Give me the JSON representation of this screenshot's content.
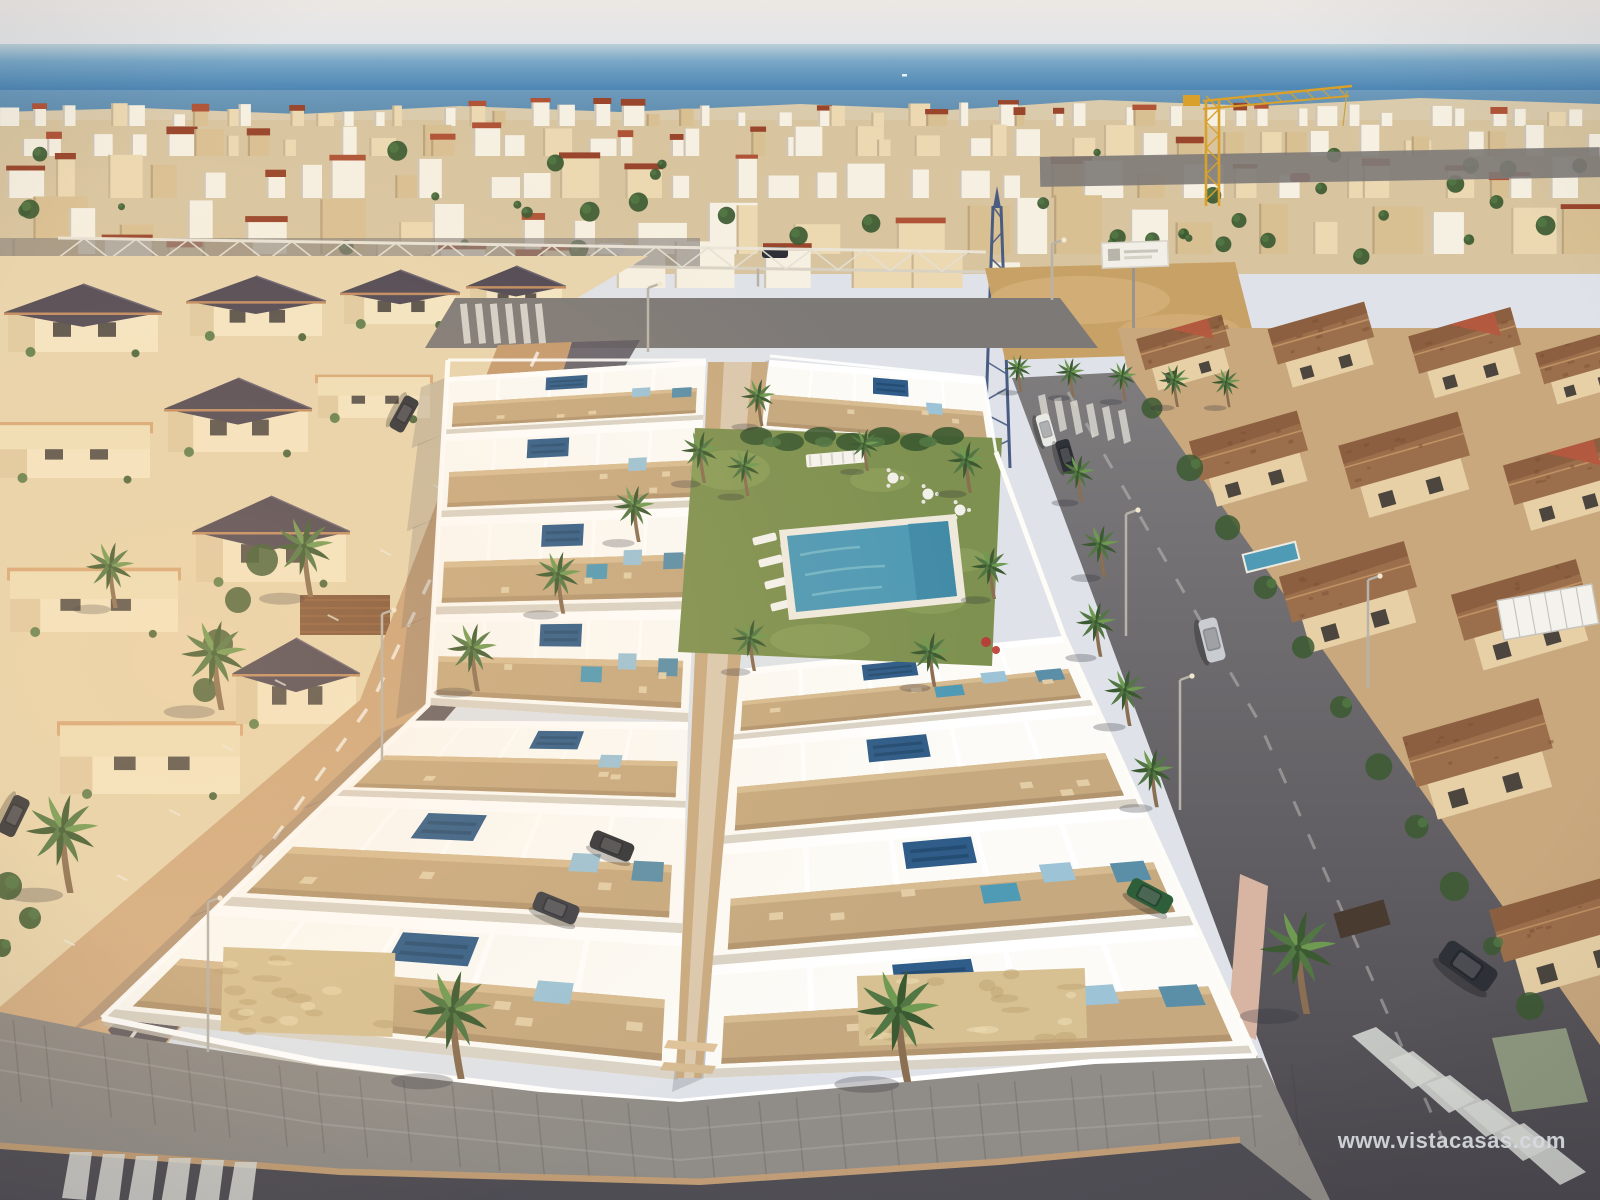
{
  "watermark": {
    "text": "www.vistacasas.com"
  },
  "palette": {
    "sky_top": "#ece8e4",
    "sky_horizon": "#e0e4e9",
    "sea_haze": "#bccfd8",
    "sea_light": "#78a6c6",
    "sea_mid": "#4a84b2",
    "sea_deep": "#38739f",
    "city_base": "#d8c5a0",
    "city_white": "#f6f0e2",
    "city_cream": "#ecd9b2",
    "city_tan": "#d9c093",
    "roof_red": "#b05438",
    "roof_red_dark": "#99462c",
    "roof_dark": "#4e4754",
    "palm_dark": "#3c5a31",
    "palm_mid": "#527744",
    "palm_light": "#6f9a52",
    "palm_trunk": "#8a6f52",
    "street_sun": "#c49a6e",
    "street_sun_deep": "#d7b288",
    "street_shadow": "#5e5a62",
    "rstreet_top": "#7e7c7d",
    "rstreet_bottom": "#4b494f",
    "asphalt": "#504e55",
    "sidewalk": "#908c87",
    "curb": "#c59f74",
    "dev_white": "#fcfbf7",
    "dev_off": "#e9e2d4",
    "dev_shadow": "#d9d3c7",
    "dev_shadow2": "#c7c0b4",
    "terrace": "#c6a97f",
    "terrace_light": "#d7bc92",
    "terrace_dark": "#b2956f",
    "solar": "#2f5c88",
    "solar_dark": "#234a6e",
    "accent_blue": "#9cc3d6",
    "accent_teal": "#5b8fa8",
    "pool": "#4f9ab5",
    "pool_light": "#85c2cd",
    "pool_dark": "#3f88a5",
    "pool_rim": "#efe9dc",
    "lawn": "#7e9150",
    "lawn_light": "#95a861",
    "sand": "#c8a166",
    "sand_light": "#d9b67f",
    "stone": "#d7c193",
    "stone_dark": "#bba06f",
    "terra_roof": "#9c6f4c",
    "terra_roof_dark": "#855a3b",
    "terra_wall": "#e7d0a6",
    "terra_red": "#b5593f",
    "crane_yellow": "#d9a02b",
    "crane_blue": "#4a5c82",
    "car_dark": "#2e3138",
    "car_silver": "#c9ccd0",
    "car_green": "#2f5e3a",
    "car_white": "#e9e9e6",
    "car_red": "#b4433a",
    "watermark": "#d7dbe0"
  }
}
